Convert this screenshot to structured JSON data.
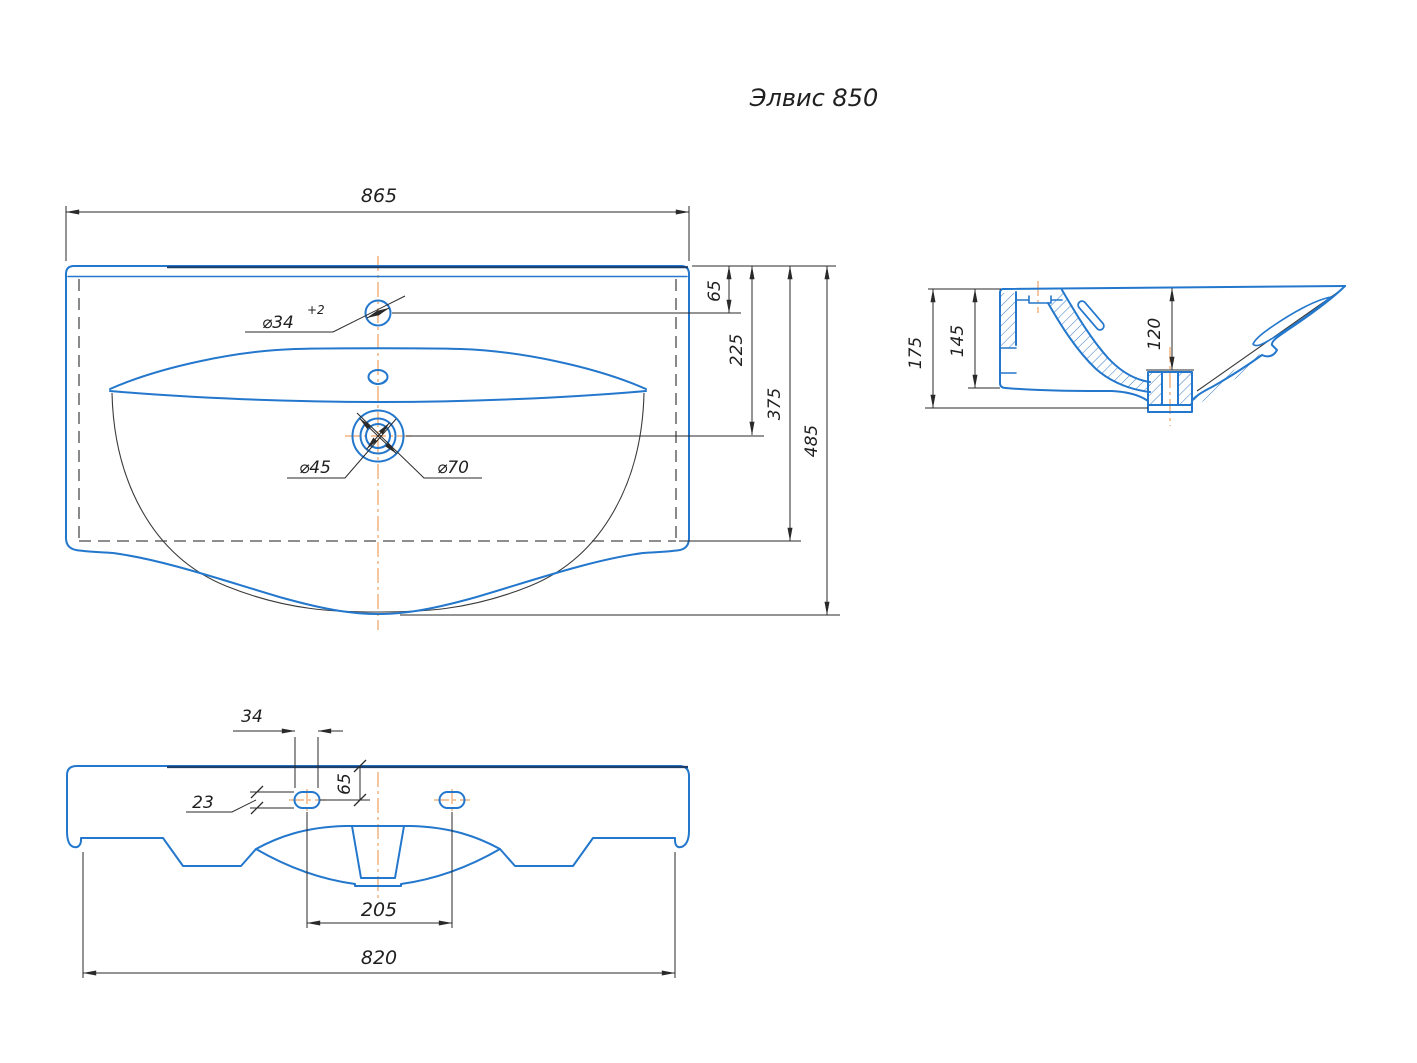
{
  "title": "Элвис 850",
  "colors": {
    "line_blue": "#2377cc",
    "line_dark": "#1c3f6e",
    "dimension": "#2a2a2a",
    "centerline_orange": "#eda263",
    "hidden_line_gray": "#4a4a4a",
    "background": "#ffffff"
  },
  "top_view": {
    "overall_width": "865",
    "faucet_offset": "65",
    "drain_offset": "225",
    "body_depth": "375",
    "overall_depth": "485",
    "faucet_hole_dia": "⌀34",
    "faucet_hole_tolerance": "+2",
    "drain_dia_inner": "⌀45",
    "drain_dia_outer": "⌀70"
  },
  "side_view": {
    "overall_height": "175",
    "back_wall_height": "145",
    "bowl_depth": "120"
  },
  "front_view": {
    "slot_width": "34",
    "slot_height": "23",
    "slot_top_offset": "65",
    "slot_spacing": "205",
    "bottom_width": "820"
  }
}
